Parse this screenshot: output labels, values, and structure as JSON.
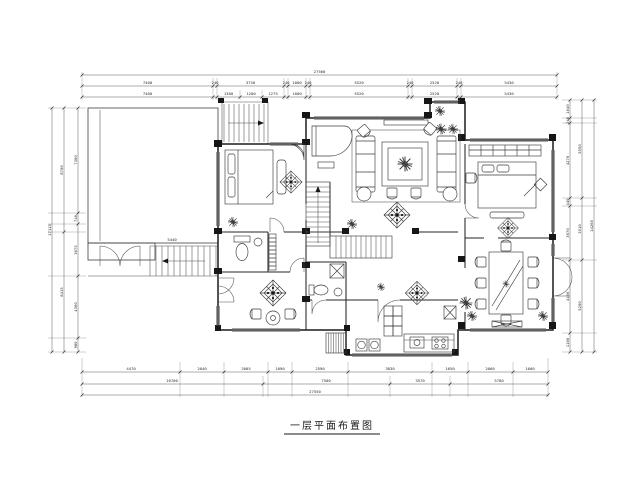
{
  "labels": {
    "title": "一层平面布置图",
    "terrace_dim": "5440"
  },
  "dims": {
    "top": {
      "total": "27560",
      "row1": [
        "7400",
        "240",
        "3750",
        "240",
        "1000",
        "240",
        "5520",
        "240",
        "2520",
        "240",
        "5430"
      ],
      "row2": [
        "7400",
        "1300",
        "1200",
        "1275",
        "1000",
        "5520",
        "2520",
        "5430"
      ]
    },
    "bottom": {
      "total": "27550",
      "row1": [
        "4470",
        "2040",
        "2005",
        "1090",
        "2590",
        "3830",
        "1650",
        "2060",
        "1600"
      ],
      "row2": [
        "10700",
        "7500",
        "3570",
        "5780"
      ]
    },
    "left": {
      "total": "17115",
      "row1": [
        "7360",
        "740",
        "3675",
        "4360",
        "980"
      ],
      "row2": [
        "8700",
        "8415"
      ]
    },
    "right": {
      "total": "14260",
      "row1": [
        "1040",
        "240",
        "4270",
        "440",
        "3070",
        "4100",
        "1100"
      ],
      "row2": [
        "5550",
        "3510",
        "5200"
      ]
    }
  }
}
